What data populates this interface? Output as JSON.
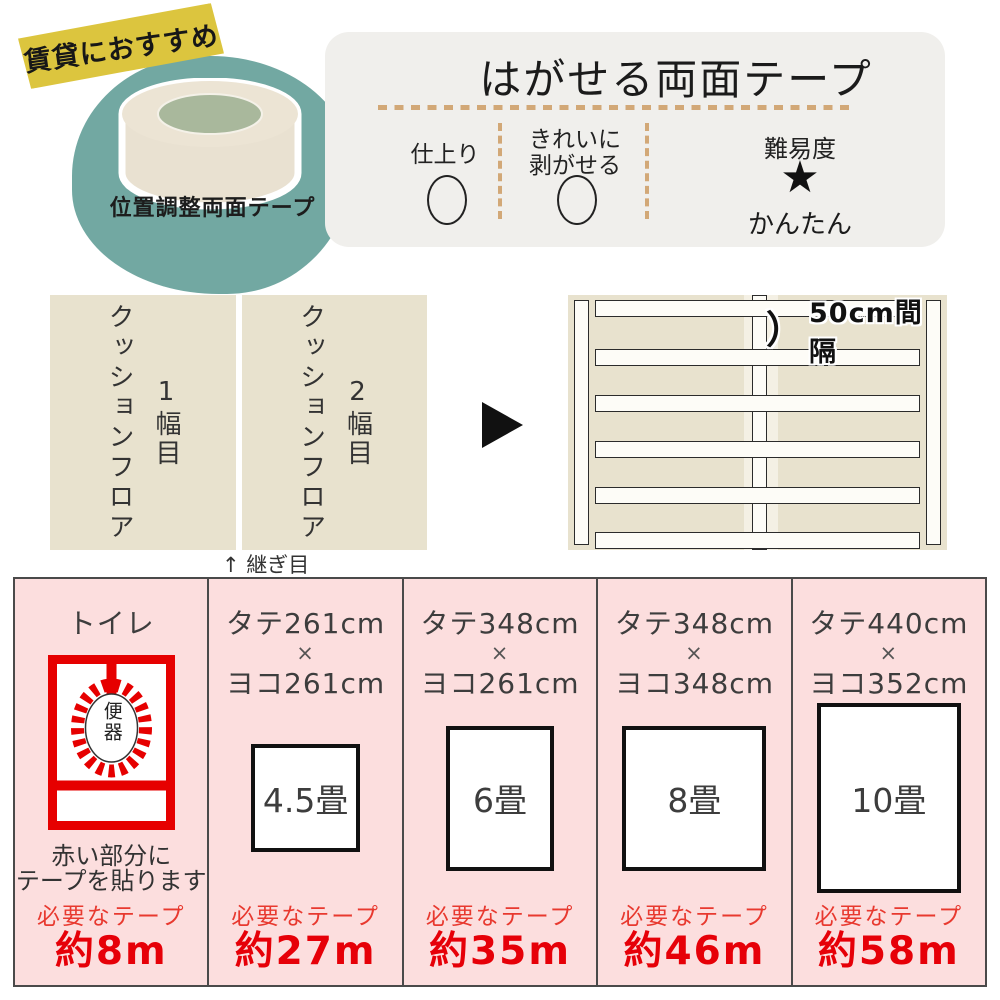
{
  "colors": {
    "teal_blob": "#72a8a2",
    "badge_yellow": "#dcc53e",
    "panel_gray": "#f0efec",
    "dash_tan": "#d2a877",
    "flooring_beige": "#e8e2ce",
    "table_pink": "#fcdede",
    "tape_red": "#e60000",
    "value_red": "#e60008",
    "table_border": "#4a4a4a"
  },
  "badge": {
    "label": "賃貸におすすめ"
  },
  "hero": {
    "product_label": "位置調整両面テープ"
  },
  "panel": {
    "title": "はがせる両面テープ",
    "f1_label": "仕上り",
    "f1_mark": "circle",
    "f2_label_l1": "きれいに",
    "f2_label_l2": "剥がせる",
    "f2_mark": "circle",
    "f3_label": "難易度",
    "f3_star": "★",
    "f3_value": "かんたん"
  },
  "middle": {
    "panel1": {
      "text": "クッションフロア",
      "label": "1幅目"
    },
    "panel2": {
      "text": "クッションフロア",
      "label": "2幅目"
    },
    "seam_arrow": "↑",
    "seam_label": "継ぎ目",
    "spacing_paren": "）",
    "spacing_label": "50cm間隔"
  },
  "table": {
    "columns": [
      {
        "header": "トイレ",
        "toilet_label": "便器",
        "note_l1": "赤い部分に",
        "note_l2": "テープを貼ります",
        "tape_label": "必要なテープ",
        "tape_value": "約8m"
      },
      {
        "size_l1": "タテ261cm",
        "size_x": "×",
        "size_l2": "ヨコ261cm",
        "tatami": "4.5畳",
        "tape_label": "必要なテープ",
        "tape_value": "約27m"
      },
      {
        "size_l1": "タテ348cm",
        "size_x": "×",
        "size_l2": "ヨコ261cm",
        "tatami": "6畳",
        "tape_label": "必要なテープ",
        "tape_value": "約35m"
      },
      {
        "size_l1": "タテ348cm",
        "size_x": "×",
        "size_l2": "ヨコ348cm",
        "tatami": "8畳",
        "tape_label": "必要なテープ",
        "tape_value": "約46m"
      },
      {
        "size_l1": "タテ440cm",
        "size_x": "×",
        "size_l2": "ヨコ352cm",
        "tatami": "10畳",
        "tape_label": "必要なテープ",
        "tape_value": "約58m"
      }
    ]
  }
}
